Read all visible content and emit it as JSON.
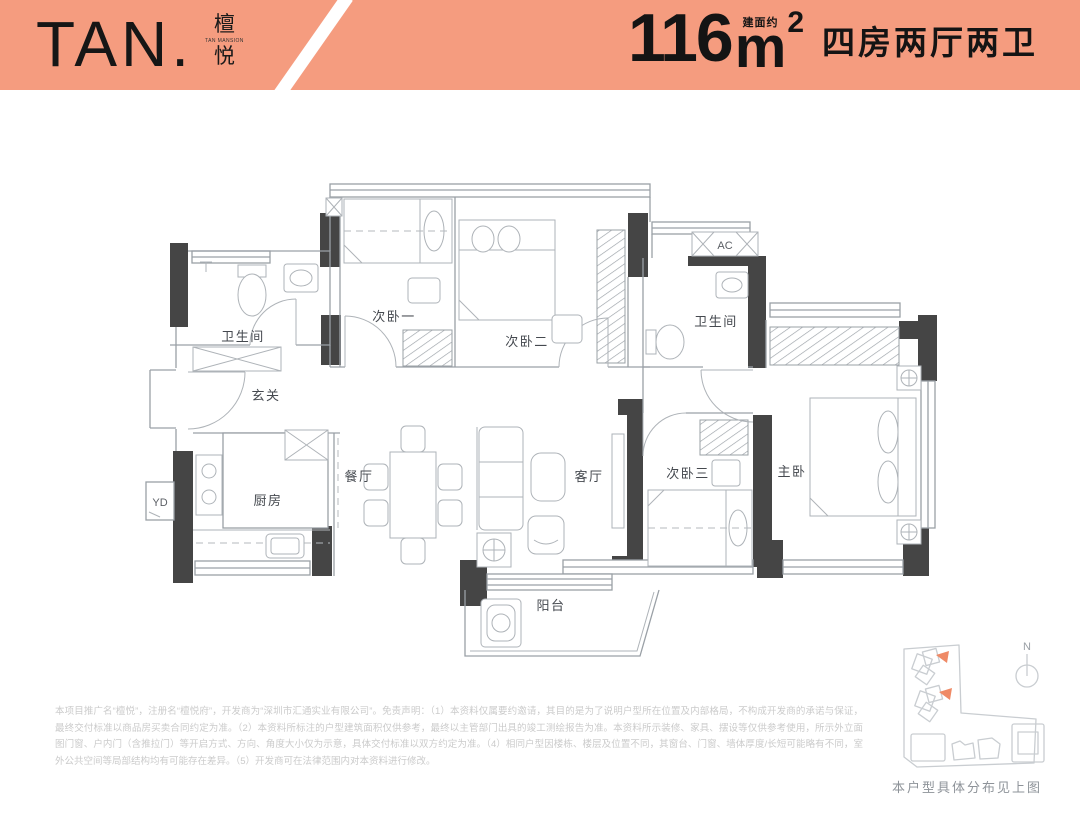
{
  "header": {
    "logo_text": "TAN.",
    "logo_cn_top": "檀",
    "logo_cn_bottom": "悦",
    "logo_sub": "TAN MANSION",
    "area_approx": "建面约",
    "area_value": "116",
    "area_unit": "m",
    "area_sup": "2",
    "layout_type": "四房两厅两卫",
    "banner_color": "#F59C7F"
  },
  "plan": {
    "rooms": {
      "bath_left": "卫生间",
      "bed1": "次卧一",
      "bed2": "次卧二",
      "bath_right": "卫生间",
      "foyer": "玄关",
      "kitchen": "厨房",
      "dining": "餐厅",
      "living": "客厅",
      "bed3": "次卧三",
      "master": "主卧",
      "balcony": "阳台",
      "yd": "YD",
      "ac": "AC"
    },
    "wall_color": "#454545",
    "line_color": "#9aa0a6"
  },
  "sitemap": {
    "caption": "本户型具体分布见上图",
    "compass": "N",
    "highlight_color": "#EF8A66"
  },
  "disclaimer": "本项目推广名“檀悦”，注册名“檀悦府”，开发商为“深圳市汇通实业有限公司”。免责声明：（1）本资料仅属要约邀请，其目的是为了说明户型所在位置及内部格局，不构成开发商的承诺与保证，最终交付标准以商品房买卖合同约定为准。（2）本资料所标注的户型建筑面积仅供参考，最终以主管部门出具的竣工测绘报告为准。本资料所示装修、家具、摆设等仅供参考使用，所示外立面图门窗、户内门（含推拉门）等开启方式、方向、角度大小仅为示意，具体交付标准以双方约定为准。（4）相同户型因楼栋、楼层及位置不同，其窗台、门窗、墙体厚度/长短可能略有不同，室外公共空间等局部结构均有可能存在差异。（5）开发商可在法律范围内对本资料进行修改。"
}
